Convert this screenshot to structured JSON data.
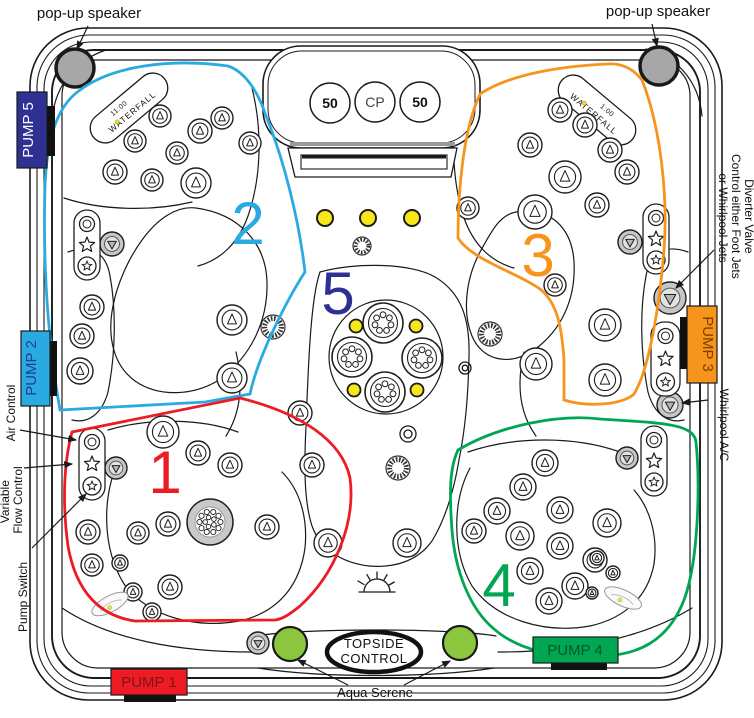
{
  "labels": {
    "speaker_left": "pop-up speaker",
    "speaker_right": "pop-up speaker",
    "air_control": "Air Control",
    "variable_line1": "Variable",
    "variable_line2": "Flow Control",
    "pump_switch": "Pump Switch",
    "diverter_line1": "Diverter Valve",
    "diverter_line2": "Control either Foot Jets",
    "diverter_line3": "or Whirlpool Jets",
    "whirlpool_ac": "Whirlpool A/C",
    "aqua_serene": "Aqua Serene",
    "topside_line1": "TOPSIDE",
    "topside_line2": "CONTROL"
  },
  "pillow": {
    "left_button": "50",
    "center_button": "CP",
    "right_button": "50"
  },
  "waterfall_left": {
    "time": "11:00",
    "name": "WATERFALL"
  },
  "waterfall_right": {
    "time": "1:00",
    "name": "WATERFALL"
  },
  "pumps": {
    "pump1": {
      "label": "PUMP 1",
      "bg": "#ED1C24",
      "fg": "#7F1416"
    },
    "pump2": {
      "label": "PUMP 2",
      "bg": "#29ABE2",
      "fg": "#1C3F94"
    },
    "pump3": {
      "label": "PUMP 3",
      "bg": "#F7941D",
      "fg": "#7B3F00"
    },
    "pump4": {
      "label": "PUMP 4",
      "bg": "#00A651",
      "fg": "#00582B"
    },
    "pump5": {
      "label": "PUMP 5",
      "bg": "#2E3192",
      "fg": "#FFFFFF"
    }
  },
  "zones": {
    "zone1": {
      "number": "1",
      "color": "#ED1C24"
    },
    "zone2": {
      "number": "2",
      "color": "#29ABE2"
    },
    "zone3": {
      "number": "3",
      "color": "#F7941D"
    },
    "zone4": {
      "number": "4",
      "color": "#00A651"
    },
    "zone5": {
      "number": "5",
      "color": "#2E3192"
    }
  },
  "accent_colors": {
    "light_yellow": "#F7E71A",
    "aqua_serene_green": "#8CC63F",
    "speaker_gray": "#A7A7A7"
  }
}
